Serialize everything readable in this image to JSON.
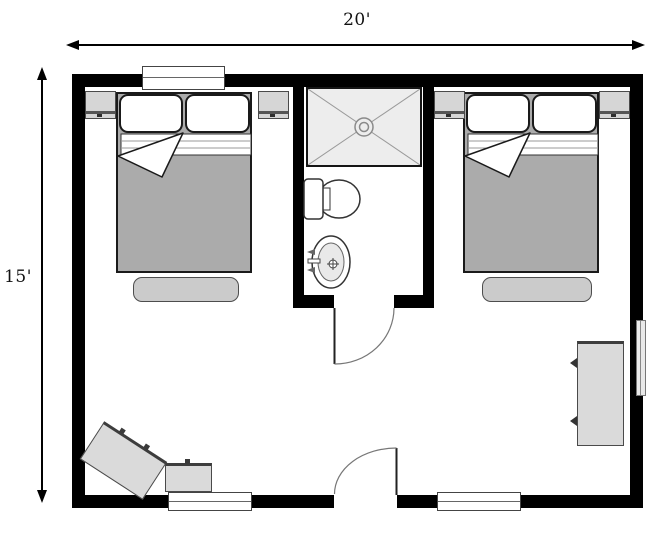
{
  "diagram": {
    "type": "floor-plan",
    "width_label": "20'",
    "height_label": "15'"
  },
  "palette": {
    "wall": "#000000",
    "floor": "#ffffff",
    "furniture_fill": "#d8d8d8",
    "bedding_fill": "#ababab",
    "fixture_fill": "#ededed",
    "outline": "#333333"
  },
  "rooms": [
    {
      "name": "bedroom-left",
      "furniture": [
        "double-bed",
        "pillow",
        "pillow",
        "nightstand",
        "nightstand",
        "bench"
      ]
    },
    {
      "name": "bathroom",
      "fixtures": [
        "shower",
        "toilet",
        "sink"
      ],
      "doors": [
        "bathroom-door"
      ]
    },
    {
      "name": "bedroom-right",
      "furniture": [
        "double-bed",
        "pillow",
        "pillow",
        "nightstand",
        "nightstand",
        "bench"
      ]
    },
    {
      "name": "main-room",
      "furniture": [
        "angled-dresser",
        "side-table",
        "dresser"
      ],
      "doors": [
        "entry-door"
      ]
    }
  ],
  "windows": [
    "top-wall-window",
    "bottom-wall-left-window",
    "bottom-wall-right-window",
    "right-wall-window"
  ]
}
